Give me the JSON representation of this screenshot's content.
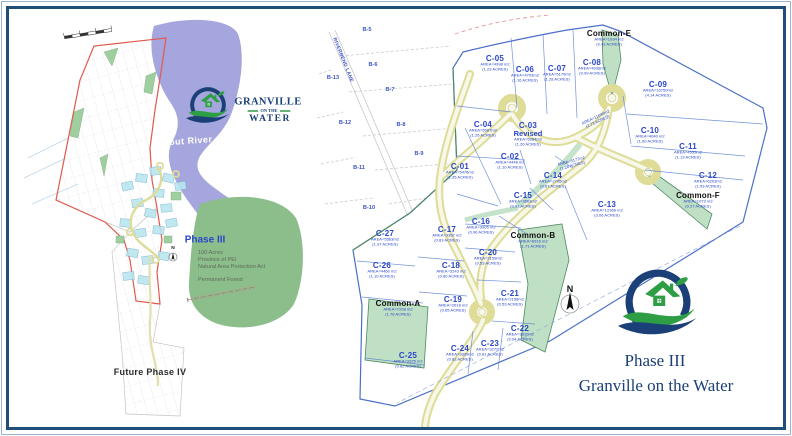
{
  "colors": {
    "label_blue": "#2946c8",
    "water": "#9e9edb",
    "forest": "#8cbe8c",
    "common_green": "#bfe0c4",
    "road_yellow": "#dedc96",
    "road_center": "#f7f7ea",
    "lot_line": "#5b7fd4",
    "boundary_blue": "#4a6fc8",
    "boundary_red": "#e05a4e",
    "navy": "#1b3f77",
    "logo_green": "#2e9e44",
    "cyan_lot": "#b9e6ef"
  },
  "left_map": {
    "river_label": "Trout River",
    "phase_label": "Phase III",
    "info_lines": [
      "100 Acres",
      "Province of PEI",
      "Natural Area Protection Act"
    ],
    "forest_label": "Permanent Forest",
    "future_label": "Future Phase IV",
    "north_label": "N"
  },
  "logo": {
    "name": "GRANVILLE",
    "mid": "ON THE",
    "bottom": "WATER"
  },
  "right_map": {
    "north_label": "N",
    "street_label": "RIVERBEND LANE",
    "b_lots": [
      {
        "id": "B-5",
        "x": 52,
        "y": 22
      },
      {
        "id": "B-6",
        "x": 58,
        "y": 57
      },
      {
        "id": "B-7",
        "x": 75,
        "y": 82
      },
      {
        "id": "B-8",
        "x": 86,
        "y": 117
      },
      {
        "id": "B-9",
        "x": 104,
        "y": 146
      },
      {
        "id": "B-10",
        "x": 54,
        "y": 200
      },
      {
        "id": "B-11",
        "x": 44,
        "y": 160
      },
      {
        "id": "B-12",
        "x": 30,
        "y": 115
      },
      {
        "id": "B-13",
        "x": 18,
        "y": 70
      }
    ],
    "lots": [
      {
        "id": "C-01",
        "area": "AREA=5476m2",
        "acres": "(1.35 ACRES)",
        "x": 145,
        "y": 167
      },
      {
        "id": "C-02",
        "area": "AREA=4448 m2",
        "acres": "(1.10 ACRES)",
        "x": 195,
        "y": 157
      },
      {
        "id": "C-03",
        "sub": "Revised",
        "area": "AREA=5084m2",
        "acres": "(1.26 ACRES)",
        "x": 213,
        "y": 130
      },
      {
        "id": "C-04",
        "area": "AREA=5087m2",
        "acres": "(1.26 ACRES)",
        "x": 168,
        "y": 125
      },
      {
        "id": "C-05",
        "area": "AREA=4998 m2",
        "acres": "(1.23 ACRES)",
        "x": 180,
        "y": 59
      },
      {
        "id": "C-06",
        "area": "AREA=4703m2",
        "acres": "(1.16 ACRES)",
        "x": 210,
        "y": 70
      },
      {
        "id": "C-07",
        "area": "AREA=5175m2",
        "acres": "(1.28 ACRES)",
        "x": 242,
        "y": 69
      },
      {
        "id": "C-08",
        "area": "AREA=4038m2",
        "acres": "(0.99 ACRES)",
        "x": 277,
        "y": 63
      },
      {
        "id": "C-09",
        "area": "AREA=16750m2",
        "acres": "(4.14 ACRES)",
        "x": 343,
        "y": 85
      },
      {
        "id": "C-10",
        "area": "AREA=4040 m2",
        "acres": "(1.00 ACRES)",
        "x": 335,
        "y": 131
      },
      {
        "id": "C-11",
        "area": "AREA=4559m2",
        "acres": "(1.13 ACRES)",
        "x": 373,
        "y": 147
      },
      {
        "id": "C-12",
        "area": "AREA=6203m2",
        "acres": "(1.53 ACRES)",
        "x": 393,
        "y": 176
      },
      {
        "id": "C-13",
        "area": "AREA=12366 m2",
        "acres": "(3.06 ACRES)",
        "x": 292,
        "y": 205
      },
      {
        "id": "C-14",
        "area": "AREA=2706m2",
        "acres": "(0.67 ACRES)",
        "x": 238,
        "y": 176
      },
      {
        "id": "C-15",
        "area": "AREA=3663m2",
        "acres": "(0.91 ACRES)",
        "x": 208,
        "y": 196
      },
      {
        "id": "C-16",
        "area": "AREA=3905 m2",
        "acres": "(0.96 ACRES)",
        "x": 166,
        "y": 222
      },
      {
        "id": "C-17",
        "area": "AREA=3357 m2",
        "acres": "(0.83 ACRES)",
        "x": 132,
        "y": 230
      },
      {
        "id": "C-18",
        "area": "AREA=3243 m2",
        "acres": "(0.80 ACRES)",
        "x": 136,
        "y": 266
      },
      {
        "id": "C-19",
        "area": "AREA=2618 m2",
        "acres": "(0.65 ACRES)",
        "x": 138,
        "y": 300
      },
      {
        "id": "C-20",
        "area": "AREA=2159m2",
        "acres": "(0.53 ACRES)",
        "x": 173,
        "y": 253
      },
      {
        "id": "C-21",
        "area": "AREA=2158m2",
        "acres": "(0.53 ACRES)",
        "x": 195,
        "y": 294
      },
      {
        "id": "C-22",
        "area": "AREA=3810m2",
        "acres": "(0.94 ACRES)",
        "x": 205,
        "y": 329
      },
      {
        "id": "C-23",
        "area": "AREA=3272m2",
        "acres": "(0.81 ACRES)",
        "x": 175,
        "y": 344
      },
      {
        "id": "C-24",
        "area": "AREA=3339m2",
        "acres": "(0.82 ACRES)",
        "x": 145,
        "y": 349
      },
      {
        "id": "C-25",
        "area": "AREA=3325 m2",
        "acres": "(0.82 ACRES)",
        "x": 93,
        "y": 356
      },
      {
        "id": "C-26",
        "area": "AREA=4460 m2",
        "acres": "(1.10 ACRES)",
        "x": 67,
        "y": 266
      },
      {
        "id": "C-27",
        "area": "AREA=5563m2",
        "acres": "(1.37 ACRES)",
        "x": 70,
        "y": 234
      }
    ],
    "commons": [
      {
        "id": "Common-A",
        "area": "AREA=7208 m2",
        "acres": "(1.78 ACRES)",
        "x": 83,
        "y": 304
      },
      {
        "id": "Common-B",
        "area": "AREA=6916 m2",
        "acres": "(1.71 ACRES)",
        "x": 218,
        "y": 236
      },
      {
        "id": "Common-E",
        "area": "AREA=1934 m2",
        "acres": "(0.42 ACRES)",
        "x": 294,
        "y": 34
      },
      {
        "id": "Common-F",
        "area": "AREA=1073 m2",
        "acres": "(0.27 ACRES)",
        "x": 383,
        "y": 196
      }
    ],
    "open_areas": [
      {
        "area": "AREA=11034m2",
        "acres": "(2.73 ACRES)",
        "x": 282,
        "y": 112,
        "rot": -25
      },
      {
        "area": "AREA=5177m2",
        "acres": "(1.28 ACRES)",
        "x": 257,
        "y": 156,
        "rot": -15
      }
    ]
  },
  "footer": {
    "phase": "Phase III",
    "title": "Granville on the Water"
  }
}
